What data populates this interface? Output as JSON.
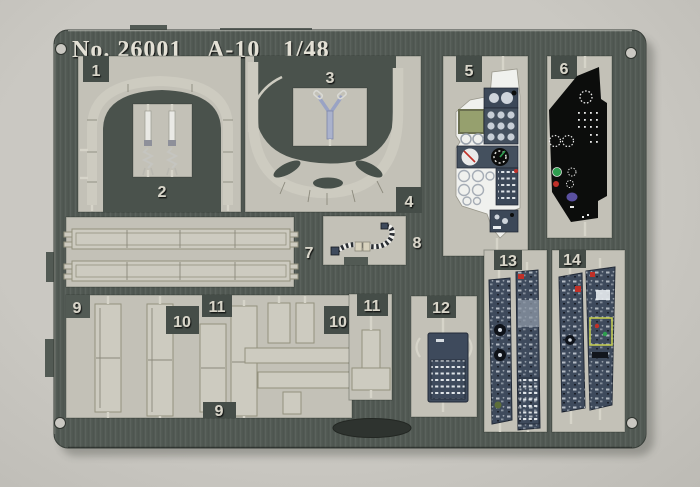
{
  "photo": {
    "subject": "photo-etched metal detail fret on paper backing",
    "title": {
      "catalog_no": "No. 26001",
      "aircraft": "A-10",
      "scale": "1/48"
    }
  },
  "part_labels": {
    "p1": "1",
    "p2": "2",
    "p3": "3",
    "p4": "4",
    "p5": "5",
    "p6": "6",
    "p7": "7",
    "p8": "8",
    "p9a": "9",
    "p9b": "9",
    "p10a": "10",
    "p10b": "10",
    "p11a": "11",
    "p11b": "11",
    "p12": "12",
    "p13": "13",
    "p14": "14"
  },
  "colors": {
    "paper": "#cac8c2",
    "cutout_paper": "#c3c1b7",
    "fret": "#525a54",
    "fret_dark": "#4a524c",
    "label_box": "#454d48",
    "etched_metal": "#cdcbc0",
    "metal_highlight": "#efeee6",
    "numeral": "#d8d5c9",
    "title_text": "#e3e0d5",
    "panel_blue": "#3e4a5c",
    "panel_black": "#0c0d0c",
    "screen_green": "#96a06e",
    "detail_white": "#f0f1ee",
    "detail_red": "#c03028",
    "detail_green": "#2e9e4f",
    "detail_purple": "#5a50a0",
    "detail_yellow": "#c2ca52"
  }
}
